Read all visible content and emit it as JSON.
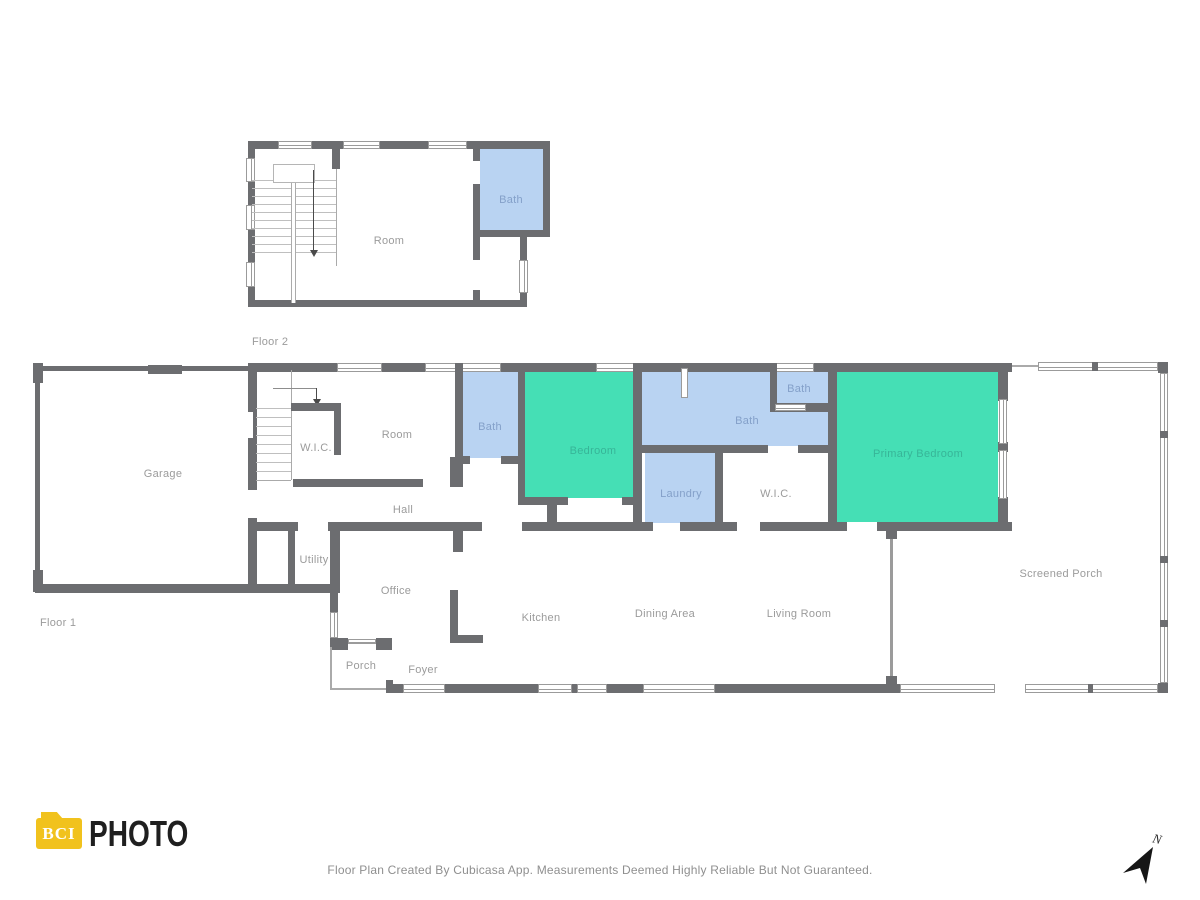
{
  "floor2": {
    "label": "Floor 2",
    "rooms": {
      "room": "Room",
      "bath": "Bath"
    }
  },
  "floor1": {
    "label": "Floor 1",
    "rooms": {
      "garage": "Garage",
      "wic_left": "W.I.C.",
      "room": "Room",
      "bath_left": "Bath",
      "bedroom": "Bedroom",
      "bath_primary": "Bath",
      "bath_small": "Bath",
      "laundry": "Laundry",
      "wic_right": "W.I.C.",
      "primary_bedroom": "Primary Bedroom",
      "hall": "Hall",
      "utility": "Utility",
      "office": "Office",
      "kitchen": "Kitchen",
      "dining_area": "Dining Area",
      "living_room": "Living Room",
      "porch": "Porch",
      "foyer": "Foyer",
      "screened_porch": "Screened Porch"
    }
  },
  "footer": {
    "logo_text": "BCI",
    "logo_suffix": "PHOTO",
    "disclaimer": "Floor Plan Created By Cubicasa App. Measurements Deemed Highly Reliable But Not Guaranteed.",
    "compass_label": "N"
  },
  "colors": {
    "wall": "#6c6d70",
    "bath_fill": "#b9d3f2",
    "bedroom_fill": "#45dfb5",
    "room_label": "#9b9b9b",
    "logo_yellow": "#f1c21d"
  }
}
